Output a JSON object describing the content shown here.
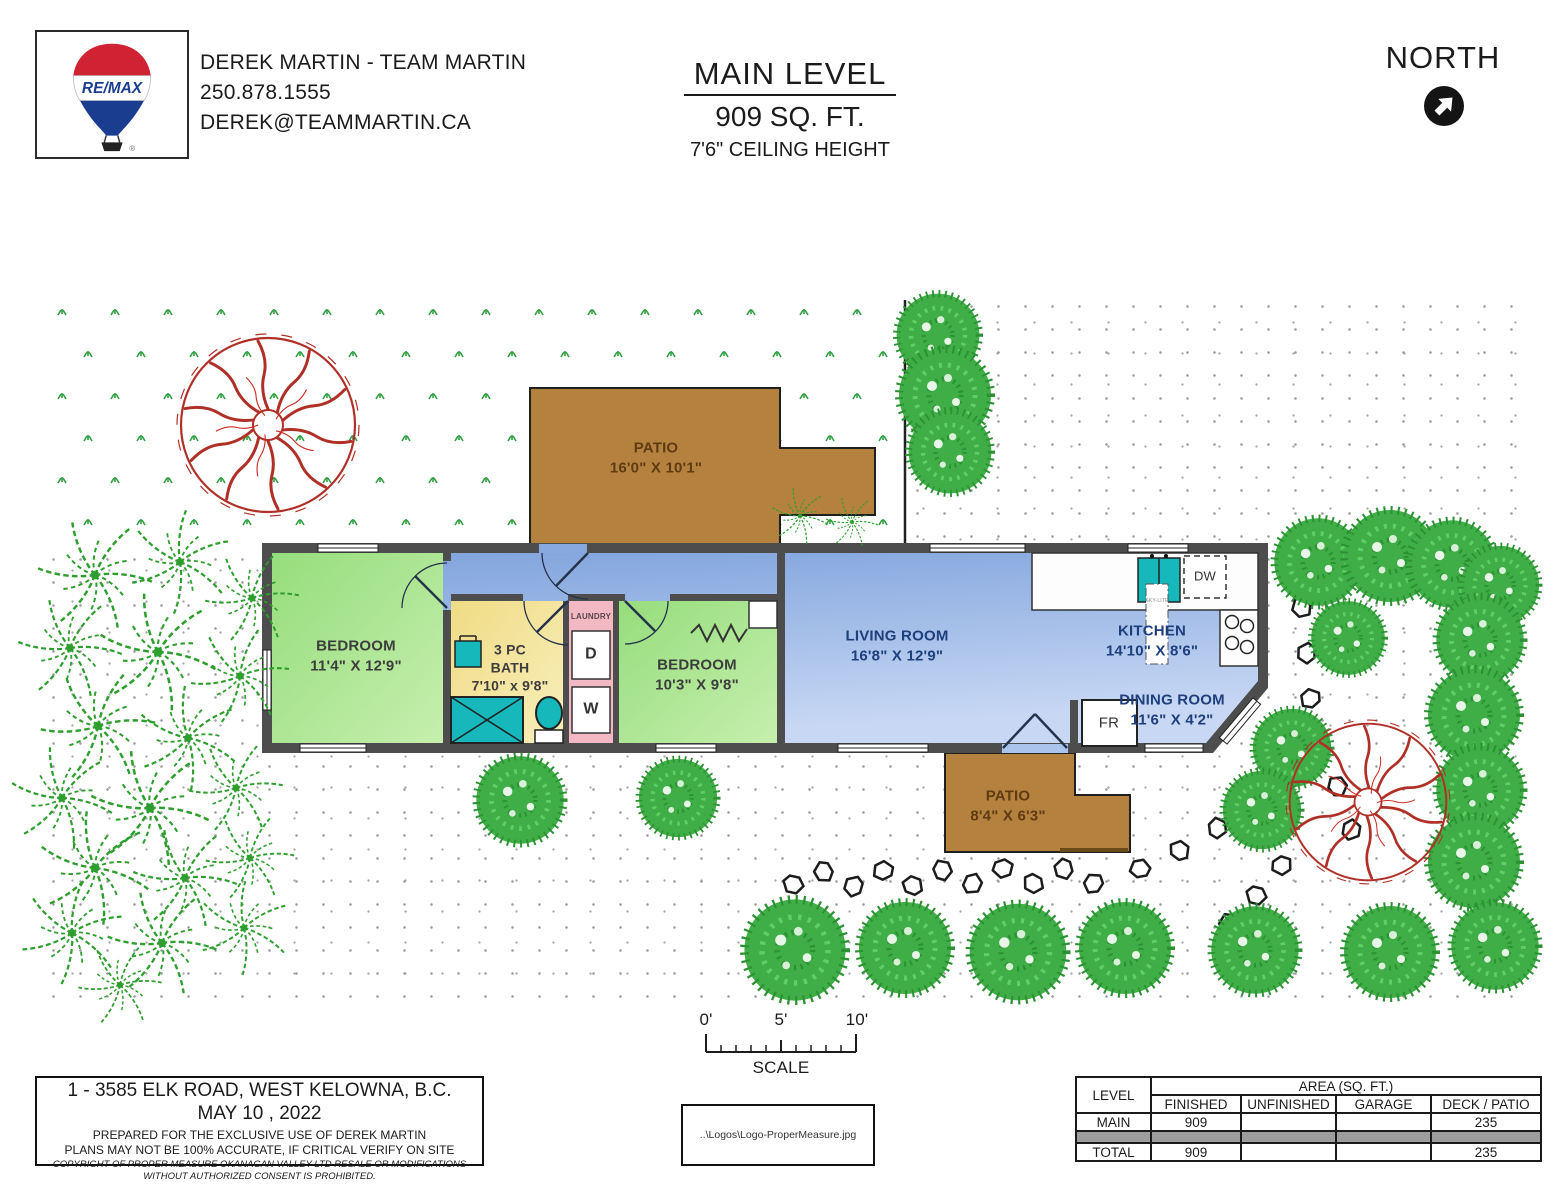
{
  "header": {
    "logo": {
      "brand": "RE/MAX",
      "registered": "®"
    },
    "agent": {
      "name": "DEREK MARTIN - TEAM MARTIN",
      "phone": "250.878.1555",
      "email": "DEREK@TEAMMARTIN.CA"
    },
    "title": {
      "level": "MAIN LEVEL",
      "area": "909 SQ. FT.",
      "ceiling": "7'6\" CEILING HEIGHT"
    },
    "compass": {
      "label": "NORTH"
    }
  },
  "rooms": {
    "bedroom1": {
      "name": "BEDROOM",
      "dims": "11'4\" X 12'9\""
    },
    "bath": {
      "line1": "3 PC",
      "line2": "BATH",
      "dims": "7'10\" x 9'8\""
    },
    "laundry": {
      "name": "LAUNDRY",
      "dryer": "D",
      "washer": "W"
    },
    "bedroom2": {
      "name": "BEDROOM",
      "dims": "10'3\" X 9'8\""
    },
    "living": {
      "name": "LIVING ROOM",
      "dims": "16'8\" X 12'9\""
    },
    "kitchen": {
      "name": "KITCHEN",
      "dims": "14'10\" X 8'6\"",
      "dishwasher": "DW",
      "skylight": "SKY-LITE"
    },
    "dining": {
      "name": "DINING ROOM",
      "dims": "11'6\" X 4'2\"",
      "fridge": "FR"
    },
    "patio_top": {
      "name": "PATIO",
      "dims": "16'0\" X 10'1\""
    },
    "patio_bottom": {
      "name": "PATIO",
      "dims": "8'4\" X 6'3\""
    }
  },
  "scale_bar": {
    "tick0": "0'",
    "tick5": "5'",
    "tick10": "10'",
    "label": "SCALE"
  },
  "info_box": {
    "address": "1 - 3585 ELK ROAD, WEST KELOWNA, B.C.",
    "date": "MAY 10 , 2022",
    "prepared": "PREPARED FOR THE EXCLUSIVE USE OF  DEREK MARTIN",
    "accuracy": "PLANS MAY NOT BE 100% ACCURATE, IF CRITICAL VERIFY ON SITE",
    "copyright": "COPYRIGHT OF PROPER MEASURE OKANAGAN VALLEY LTD  RESALE OR MODIFICATIONS WITHOUT AUTHORIZED CONSENT IS PROHIBITED."
  },
  "logo_placeholder": {
    "path_text": "..\\Logos\\Logo-ProperMeasure.jpg"
  },
  "area_table": {
    "level_header": "LEVEL",
    "area_header": "AREA (SQ. FT.)",
    "columns": [
      "FINISHED",
      "UNFINISHED",
      "GARAGE",
      "DECK / PATIO"
    ],
    "main_row": {
      "label": "MAIN",
      "finished": "909",
      "unfinished": "",
      "garage": "",
      "deck_patio": "235"
    },
    "total_row": {
      "label": "TOTAL",
      "finished": "909",
      "unfinished": "",
      "garage": "",
      "deck_patio": "235"
    }
  }
}
